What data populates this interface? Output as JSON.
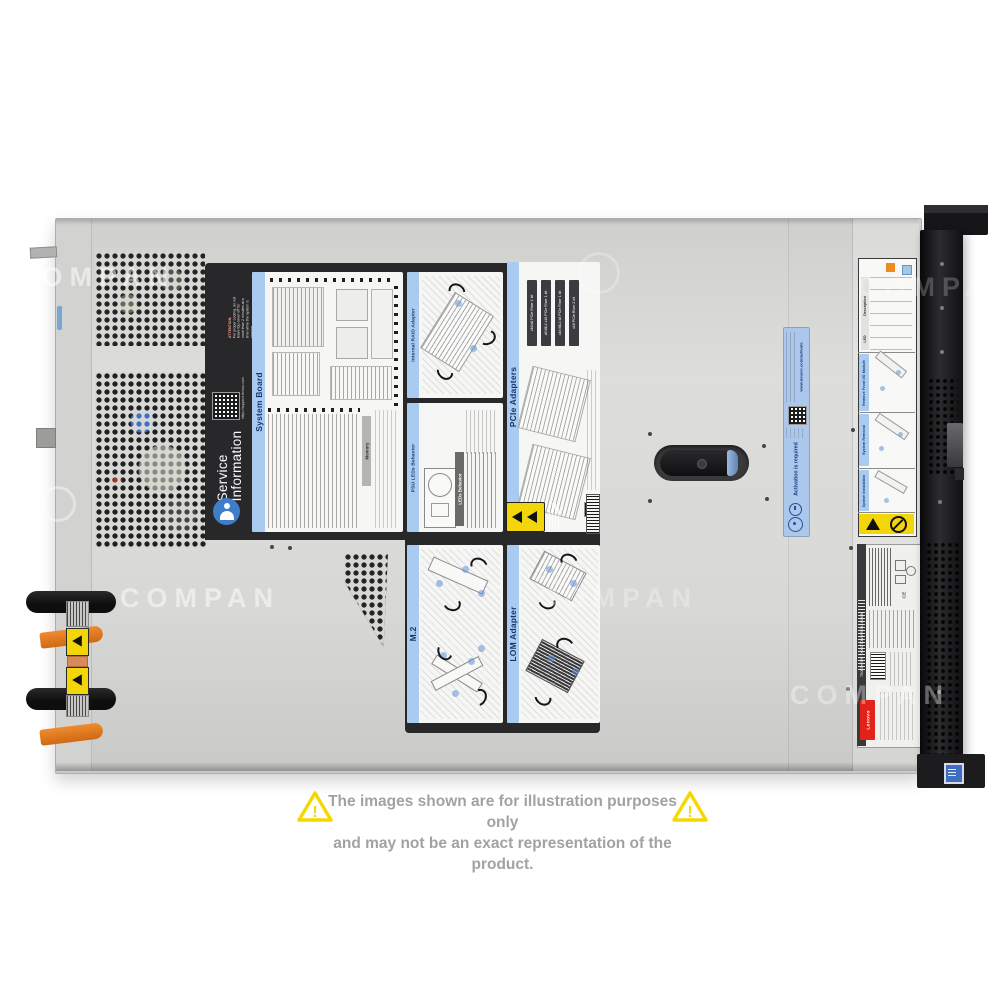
{
  "watermark": {
    "text": "COMPAN"
  },
  "disclaimer": {
    "line1": "The images shown are for illustration purposes only",
    "line2": "and may not be an exact representation of the product."
  },
  "service_label": {
    "attention_title": "ATTENTION:",
    "attention_body": "For proper cooling, do not leave top cover off for more than 2 minutes at a time while the system is running.",
    "qr_caption": "https://support.lenovo.com",
    "brand_line1": "Service",
    "brand_line2": "Information",
    "panels": {
      "system_board": "System Board",
      "memory": "Memory",
      "internal_raid": "Internal RAID Adapter",
      "psu_leds": "PSU LEDs Behavior",
      "leds_behavior": "LEDs Behavior",
      "pcie": "PCIe Adapters",
      "m2": "M.2",
      "lom": "LOM Adapter"
    },
    "pcie_risers": [
      "x16/x8 PCIe Riser 1 kit",
      "x8 ML2 x16 PCIe Riser 1 kit",
      "x16 ML2 x8 PCIe Riser 1 kit",
      "x16 PCIe Riser 2 kit"
    ]
  },
  "activation_label": {
    "text": "Activation is required",
    "url": "www.lenovo.com/activate"
  },
  "front_label": {
    "sections": [
      "Remove Front I/O Module",
      "System Removal",
      "System Installation"
    ],
    "table": {
      "led": "LED",
      "description": "Description"
    }
  },
  "regulatory_label": {
    "brand": "Lenovo",
    "serial": "7X06TH S/N 7X06CTO1WW-S44Y0588",
    "ce": "CE"
  },
  "colors": {
    "accent_blue": "#a9cbf0",
    "label_black": "#28282b",
    "warning_yellow": "#f2d60a",
    "lenovo_red": "#e2231a",
    "psu_orange": "#e1791f"
  }
}
